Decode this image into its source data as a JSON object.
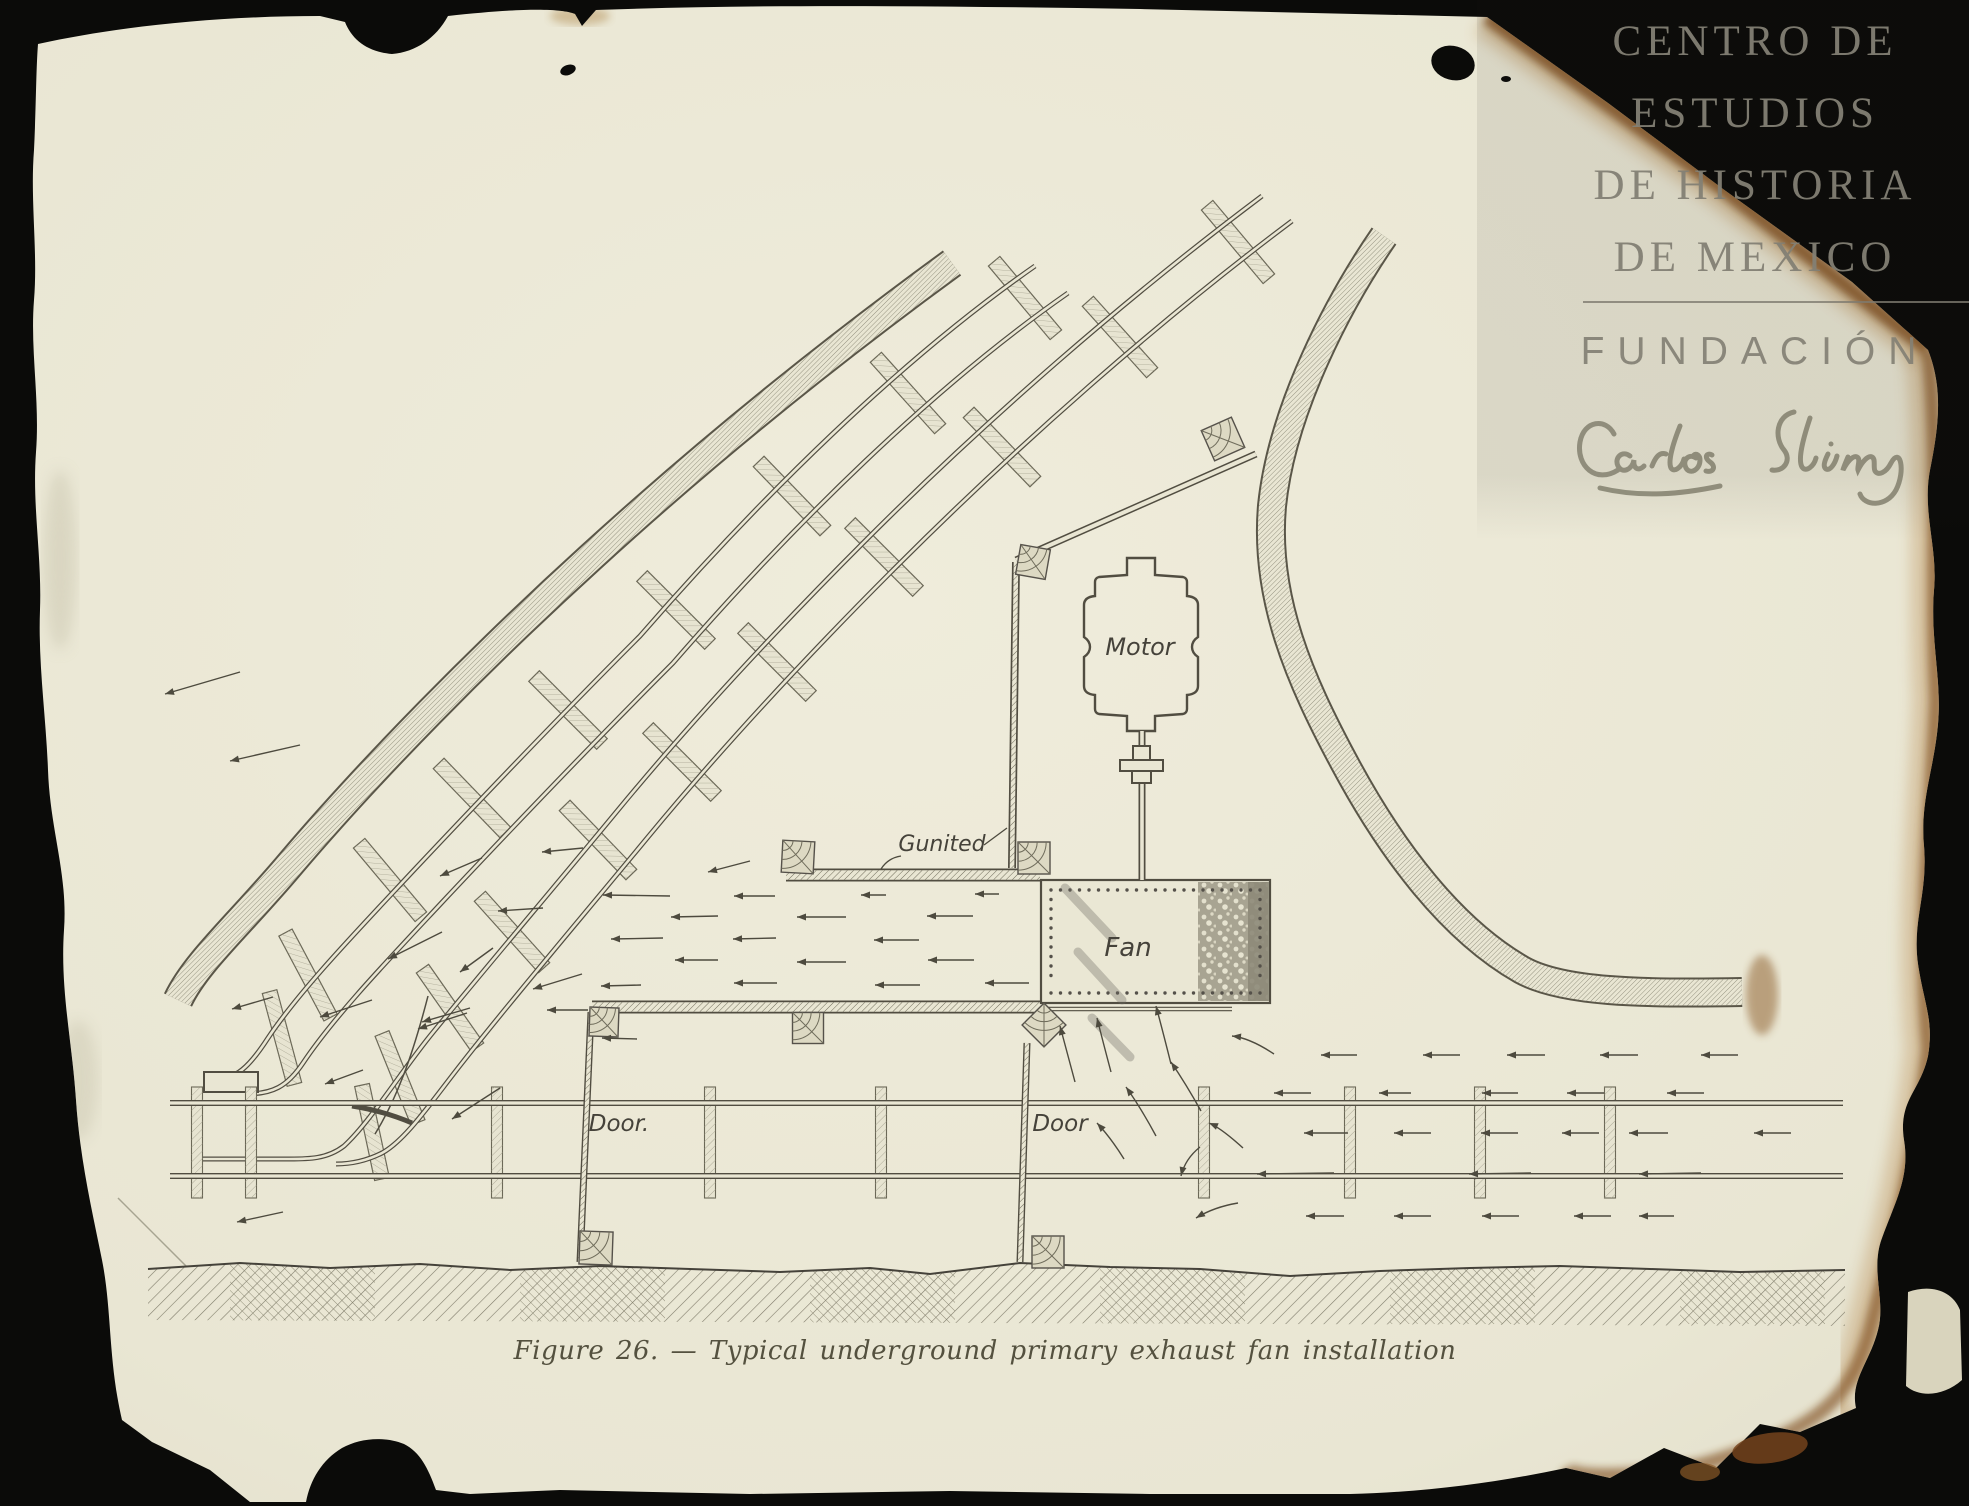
{
  "page": {
    "background_color": "#0b0b09",
    "paper_color": "#e9e6d3"
  },
  "watermark": {
    "lines": [
      "CENTRO DE",
      "ESTUDIOS",
      "DE HISTORIA",
      "DE MEXICO"
    ],
    "foundation": "FUNDACIÓN",
    "signature": "Carlos Slim"
  },
  "figure": {
    "caption": "Figure 26. — Typical underground primary exhaust fan installation"
  },
  "diagram": {
    "colors": {
      "ink": "#4d4a3e",
      "hatch": "#8e8b79",
      "label_ink": "#45423a",
      "paper": "#e9e6d3",
      "burnt_edge": "#7a4716",
      "watermark_text": "#84816f"
    },
    "labels": [
      {
        "id": "motor",
        "text": "Motor",
        "x": 1140,
        "y": 655,
        "s": 24
      },
      {
        "id": "fan",
        "text": "Fan",
        "x": 1128,
        "y": 956,
        "s": 26
      },
      {
        "id": "gunited",
        "text": "Gunited",
        "x": 942,
        "y": 851,
        "s": 22
      },
      {
        "id": "door-left",
        "text": "Door.",
        "x": 619,
        "y": 1131,
        "s": 23
      },
      {
        "id": "door-right",
        "text": "Door",
        "x": 1060,
        "y": 1131,
        "s": 23
      }
    ],
    "leader_lines": [
      [
        984,
        845,
        1007,
        828
      ]
    ],
    "leader_curves": [
      [
        901,
        856,
        888,
        858,
        881,
        869
      ]
    ],
    "flow_arrows": [
      [
        775,
        896,
        734,
        896
      ],
      [
        886,
        895,
        861,
        895
      ],
      [
        999,
        894,
        975,
        894
      ],
      [
        718,
        916,
        671,
        917
      ],
      [
        846,
        917,
        797,
        917
      ],
      [
        973,
        916,
        927,
        916
      ],
      [
        776,
        938,
        733,
        939
      ],
      [
        919,
        940,
        874,
        940
      ],
      [
        663,
        938,
        611,
        939
      ],
      [
        718,
        960,
        675,
        960
      ],
      [
        846,
        962,
        797,
        962
      ],
      [
        974,
        960,
        928,
        960
      ],
      [
        777,
        983,
        734,
        983
      ],
      [
        920,
        985,
        875,
        985
      ],
      [
        1029,
        983,
        985,
        983
      ],
      [
        641,
        985,
        601,
        986
      ],
      [
        750,
        861,
        708,
        872
      ],
      [
        670,
        896,
        603,
        895
      ],
      [
        588,
        1010,
        547,
        1010
      ],
      [
        637,
        1039,
        602,
        1038
      ],
      [
        582,
        974,
        533,
        989
      ],
      [
        543,
        908,
        498,
        911
      ],
      [
        583,
        848,
        542,
        852
      ],
      [
        482,
        858,
        440,
        876
      ],
      [
        493,
        948,
        460,
        972
      ],
      [
        442,
        932,
        388,
        959
      ],
      [
        467,
        1013,
        418,
        1029
      ],
      [
        372,
        1000,
        320,
        1017
      ],
      [
        273,
        997,
        232,
        1009
      ],
      [
        470,
        1008,
        422,
        1022
      ],
      [
        240,
        672,
        165,
        694
      ],
      [
        300,
        745,
        230,
        761
      ],
      [
        500,
        1088,
        452,
        1119
      ],
      [
        363,
        1070,
        325,
        1084
      ],
      [
        283,
        1212,
        237,
        1222
      ],
      [
        1357,
        1055,
        1321,
        1055
      ],
      [
        1460,
        1055,
        1423,
        1055
      ],
      [
        1545,
        1055,
        1507,
        1055
      ],
      [
        1638,
        1055,
        1600,
        1055
      ],
      [
        1738,
        1055,
        1701,
        1055
      ],
      [
        1311,
        1093,
        1274,
        1093
      ],
      [
        1411,
        1093,
        1379,
        1093
      ],
      [
        1518,
        1093,
        1482,
        1093
      ],
      [
        1604,
        1093,
        1567,
        1093
      ],
      [
        1704,
        1093,
        1667,
        1093
      ],
      [
        1348,
        1133,
        1304,
        1133
      ],
      [
        1431,
        1133,
        1394,
        1133
      ],
      [
        1518,
        1133,
        1481,
        1133
      ],
      [
        1599,
        1133,
        1562,
        1133
      ],
      [
        1668,
        1133,
        1629,
        1133
      ],
      [
        1791,
        1133,
        1754,
        1133
      ],
      [
        1334,
        1173,
        1257,
        1174
      ],
      [
        1531,
        1173,
        1469,
        1174
      ],
      [
        1701,
        1173,
        1639,
        1174
      ],
      [
        1344,
        1216,
        1306,
        1216
      ],
      [
        1431,
        1216,
        1394,
        1216
      ],
      [
        1519,
        1216,
        1482,
        1216
      ],
      [
        1611,
        1216,
        1574,
        1216
      ],
      [
        1674,
        1216,
        1639,
        1216
      ]
    ],
    "curved_arrows": [
      [
        1075,
        1082,
        1067,
        1052,
        1060,
        1026
      ],
      [
        1111,
        1072,
        1103,
        1042,
        1097,
        1018
      ],
      [
        1171,
        1064,
        1163,
        1032,
        1156,
        1006
      ],
      [
        1274,
        1054,
        1250,
        1038,
        1232,
        1036
      ],
      [
        1124,
        1159,
        1111,
        1138,
        1097,
        1123
      ],
      [
        1156,
        1136,
        1141,
        1108,
        1126,
        1087
      ],
      [
        1201,
        1111,
        1186,
        1084,
        1171,
        1062
      ],
      [
        1243,
        1148,
        1221,
        1128,
        1209,
        1123
      ],
      [
        1238,
        1203,
        1214,
        1207,
        1196,
        1218
      ],
      [
        1200,
        1147,
        1185,
        1159,
        1181,
        1176
      ]
    ],
    "timber_posts": [
      {
        "x": 1033,
        "y": 562,
        "s": 30,
        "a": 10
      },
      {
        "x": 1223,
        "y": 439,
        "s": 33,
        "a": -24
      },
      {
        "x": 798,
        "y": 857,
        "s": 32,
        "a": 3
      },
      {
        "x": 1034,
        "y": 858,
        "s": 32,
        "a": 0
      },
      {
        "x": 604,
        "y": 1022,
        "s": 29,
        "a": 2
      },
      {
        "x": 808,
        "y": 1028,
        "s": 31,
        "a": 0
      },
      {
        "x": 1044,
        "y": 1025,
        "s": 31,
        "a": 45
      },
      {
        "x": 596,
        "y": 1248,
        "s": 33,
        "a": 2
      },
      {
        "x": 1048,
        "y": 1252,
        "s": 32,
        "a": 0
      }
    ],
    "haulage_ties_x": [
      197,
      251,
      497,
      710,
      881,
      1204,
      1350,
      1480,
      1610
    ],
    "incline_ties": [
      {
        "x": 1025,
        "y": 298,
        "r": 50
      },
      {
        "x": 908,
        "y": 393,
        "r": 48
      },
      {
        "x": 792,
        "y": 496,
        "r": 46
      },
      {
        "x": 676,
        "y": 610,
        "r": 45
      },
      {
        "x": 568,
        "y": 710,
        "r": 45
      },
      {
        "x": 472,
        "y": 798,
        "r": 46
      },
      {
        "x": 390,
        "y": 880,
        "r": 50
      },
      {
        "x": 308,
        "y": 975,
        "r": 62
      },
      {
        "x": 282,
        "y": 1038,
        "r": 75
      },
      {
        "x": 1238,
        "y": 242,
        "r": 50
      },
      {
        "x": 1120,
        "y": 337,
        "r": 48
      },
      {
        "x": 1002,
        "y": 447,
        "r": 46
      },
      {
        "x": 884,
        "y": 557,
        "r": 45
      },
      {
        "x": 777,
        "y": 662,
        "r": 45
      },
      {
        "x": 682,
        "y": 762,
        "r": 45
      },
      {
        "x": 598,
        "y": 840,
        "r": 46
      },
      {
        "x": 512,
        "y": 932,
        "r": 48
      },
      {
        "x": 450,
        "y": 1008,
        "r": 55
      },
      {
        "x": 400,
        "y": 1078,
        "r": 68
      },
      {
        "x": 372,
        "y": 1132,
        "r": 78
      }
    ],
    "pencil_streaks": [
      [
        1065,
        888,
        1112,
        938
      ],
      [
        1078,
        952,
        1122,
        1000
      ],
      [
        1092,
        1018,
        1130,
        1057
      ]
    ],
    "rivet_box": {
      "x": 1041,
      "y": 880,
      "w": 229,
      "h": 123,
      "inset": 10,
      "step": 9.5,
      "r": 1.7
    },
    "floor_patches": [
      {
        "x": 230
      },
      {
        "x": 520
      },
      {
        "x": 810
      },
      {
        "x": 1100
      },
      {
        "x": 1390
      },
      {
        "x": 1680
      }
    ]
  }
}
